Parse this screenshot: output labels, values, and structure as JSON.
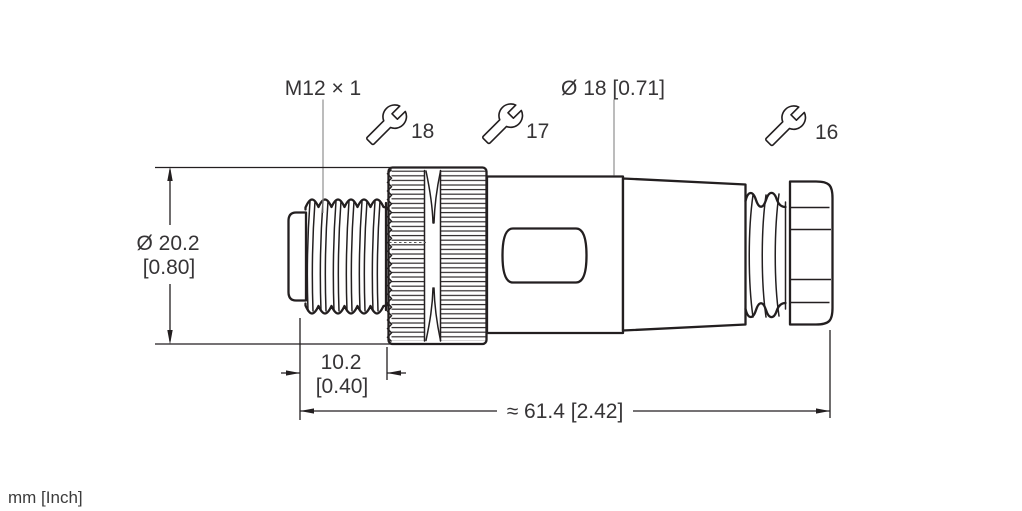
{
  "colors": {
    "line": "#231f20",
    "text": "#363436",
    "leader_line": "#8f8f8f",
    "background": "#ffffff"
  },
  "units_note": "mm [Inch]",
  "labels": {
    "thread_spec": "M12 × 1",
    "body_diameter": "Ø 18 [0.71]",
    "nut_diameter_mm": "Ø 20.2",
    "nut_diameter_inch": "[0.80]",
    "thread_length_mm": "10.2",
    "thread_length_inch": "[0.40]",
    "overall_length": "≈ 61.4 [2.42]"
  },
  "wrench_flats": [
    {
      "icon": "wrench-icon",
      "size": "18"
    },
    {
      "icon": "wrench-icon",
      "size": "17"
    },
    {
      "icon": "wrench-icon",
      "size": "16"
    }
  ]
}
